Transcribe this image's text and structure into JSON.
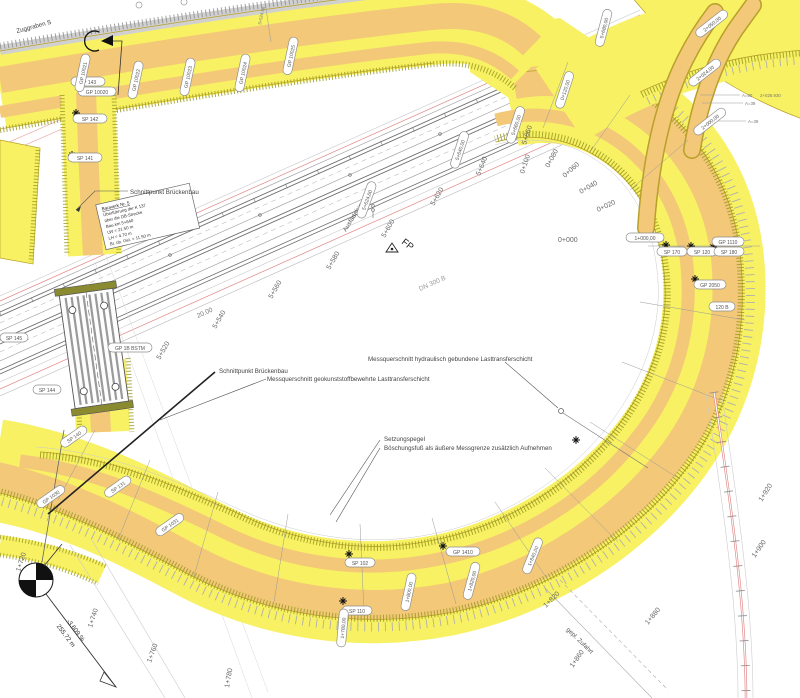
{
  "annotations": {
    "zuggraben": "Zuggraben S",
    "schnittpunkt_1": "Schnittpunkt Brückenbau",
    "schnittpunkt_2": "Schnittpunkt Brückenbau",
    "ausfaedelsignal": "Ausfädelsignal",
    "fp_marker": "FP",
    "mq_hydraulisch": "Messquerschnitt hydraulisch gebundene Lasttransferschicht",
    "mq_geokunststoff": "Messquerschnitt geokunststoffbewehrte Lasttransferschicht",
    "setzungspegel": "Setzungspegel",
    "boeschungsfuss": "Böschungsfuß als äußere Messgrenze zusätzlich Aufnehmen",
    "gepl_zufahrt": "gepl. Zufahrt",
    "gradient": "-3.609 %",
    "laenge": "255.72 m",
    "dn_label": "DN 300 B",
    "dim_20": "20.00",
    "a80": "A=80",
    "st_2026": "2+026.930",
    "a39_1": "A=39",
    "a39_2": "A=39",
    "st_3524": "3+524.86"
  },
  "bridge_box": {
    "l1": "Bauwerk Nr. 5",
    "l2": "Überführung der K 137",
    "l3": "über die DB-Strecke",
    "l4": "Bau-km 5+640",
    "l5": "LW = 21.50 m",
    "l6": "LH = 4.70 m",
    "l7": "Br. üb. Gel. = 11.50 m"
  },
  "chainage_ring": [
    "0+000",
    "0+020",
    "0+040",
    "0+060",
    "0+080",
    "0+100"
  ],
  "chainage_rail": [
    "5+580",
    "5+600",
    "5+620",
    "5+640",
    "5+660"
  ],
  "chainage_rail_2": [
    "5+520",
    "5+540",
    "5+560"
  ],
  "chainage_loop": [
    "1+720",
    "1+740",
    "1+760",
    "1+780",
    "1+820",
    "1+860",
    "1+880",
    "1+900",
    "1+920"
  ],
  "pills": [
    "SP 143",
    "GP 10020",
    "SP 142",
    "SP 141",
    "GP 10021",
    "GP 10022",
    "GP 10023",
    "GP 10024",
    "GP 10025",
    "2+050,00",
    "2+024,00",
    "2+000,00",
    "5+680,00",
    "0+120,00",
    "5+660,00",
    "5+640,00",
    "5+624,00",
    "1+000,00",
    "SP 170",
    "SP 120",
    "GP 1110",
    "SP 180",
    "GP 2050",
    "120 B",
    "SP 102",
    "GP 1410",
    "SP 110",
    "1+780,00",
    "1+800,00",
    "1+820,00",
    "1+840,00",
    "SP 140",
    "GP 1030",
    "SP 131",
    "GP 1031",
    "SP 145",
    "SP 144",
    "GP 1B BSTM"
  ],
  "colors": {
    "road_yellow": "#f7f163",
    "lane_orange": "#f3c878",
    "edge_olive": "#9a9a20",
    "rail_gray": "#6f6f6f",
    "red_line": "#e08484",
    "text_gray": "#555555"
  }
}
